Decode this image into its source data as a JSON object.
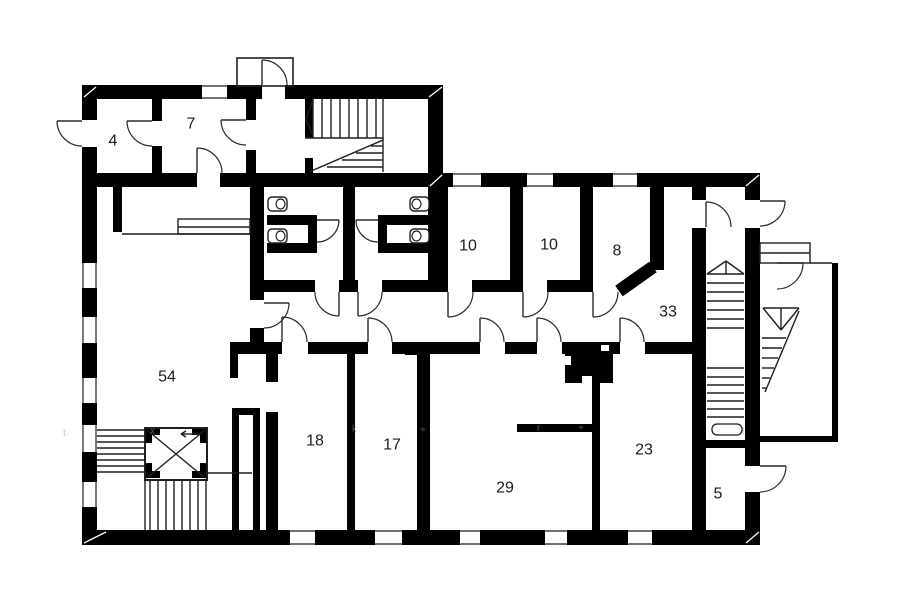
{
  "meta": {
    "title": "floor-plan",
    "bg": "#ffffff",
    "wall_color": "#000000",
    "line_color": "#1f1f1f",
    "door_color": "#2a2a2a",
    "label_color": "#1c1c1c",
    "watermark_color": "#9a9a9a",
    "label_font_size": 16
  },
  "labels": [
    {
      "t": "4",
      "x": 113,
      "y": 141
    },
    {
      "t": "7",
      "x": 191,
      "y": 124
    },
    {
      "t": "10",
      "x": 468,
      "y": 246
    },
    {
      "t": "10",
      "x": 549,
      "y": 245
    },
    {
      "t": "8",
      "x": 617,
      "y": 251
    },
    {
      "t": "33",
      "x": 668,
      "y": 312
    },
    {
      "t": "54",
      "x": 167,
      "y": 377
    },
    {
      "t": "18",
      "x": 315,
      "y": 441
    },
    {
      "t": "17",
      "x": 392,
      "y": 445
    },
    {
      "t": "29",
      "x": 505,
      "y": 488
    },
    {
      "t": "23",
      "x": 644,
      "y": 450
    },
    {
      "t": "5",
      "x": 718,
      "y": 494
    }
  ],
  "walls": [
    [
      82,
      85,
      15,
      35
    ],
    [
      82,
      147,
      15,
      398
    ],
    [
      82,
      85,
      180,
      14
    ],
    [
      285,
      85,
      158,
      14
    ],
    [
      428,
      85,
      15,
      102
    ],
    [
      443,
      173,
      317,
      14
    ],
    [
      82,
      173,
      115,
      14
    ],
    [
      220,
      173,
      223,
      14
    ],
    [
      745,
      173,
      15,
      27
    ],
    [
      745,
      228,
      15,
      238
    ],
    [
      745,
      492,
      15,
      53
    ],
    [
      82,
      530,
      678,
      15
    ],
    [
      152,
      97,
      10,
      24
    ],
    [
      152,
      146,
      10,
      27
    ],
    [
      246,
      97,
      10,
      23
    ],
    [
      246,
      150,
      10,
      23
    ],
    [
      305,
      98,
      8,
      40
    ],
    [
      305,
      158,
      8,
      29
    ],
    [
      250,
      186,
      14,
      114
    ],
    [
      250,
      328,
      14,
      14
    ],
    [
      343,
      186,
      12,
      94
    ],
    [
      428,
      186,
      20,
      94
    ],
    [
      510,
      186,
      13,
      94
    ],
    [
      580,
      186,
      13,
      94
    ],
    [
      650,
      186,
      14,
      84
    ],
    [
      692,
      187,
      14,
      13
    ],
    [
      692,
      228,
      14,
      302
    ],
    [
      255,
      280,
      60,
      12
    ],
    [
      339,
      280,
      19,
      12
    ],
    [
      382,
      280,
      66,
      12
    ],
    [
      472,
      280,
      51,
      12
    ],
    [
      547,
      280,
      46,
      12
    ],
    [
      230,
      342,
      52,
      12
    ],
    [
      308,
      342,
      60,
      12
    ],
    [
      392,
      342,
      88,
      12
    ],
    [
      505,
      342,
      32,
      12
    ],
    [
      562,
      342,
      58,
      12
    ],
    [
      645,
      342,
      61,
      12
    ],
    [
      347,
      354,
      8,
      176
    ],
    [
      417,
      343,
      13,
      189
    ],
    [
      405,
      343,
      12,
      12
    ],
    [
      266,
      354,
      12,
      28
    ],
    [
      266,
      412,
      12,
      118
    ],
    [
      592,
      382,
      8,
      148
    ],
    [
      517,
      424,
      80,
      8
    ],
    [
      692,
      440,
      68,
      8
    ],
    [
      565,
      345,
      48,
      38
    ],
    [
      267,
      215,
      50,
      10
    ],
    [
      267,
      243,
      50,
      10
    ],
    [
      308,
      225,
      9,
      18
    ],
    [
      378,
      215,
      50,
      10
    ],
    [
      378,
      243,
      50,
      10
    ],
    [
      378,
      225,
      9,
      18
    ],
    [
      232,
      408,
      28,
      7
    ],
    [
      232,
      415,
      7,
      117
    ],
    [
      253,
      415,
      7,
      117
    ],
    [
      230,
      354,
      8,
      24
    ],
    [
      832,
      263,
      6,
      179
    ],
    [
      760,
      436,
      78,
      6
    ],
    [
      113,
      186,
      9,
      46
    ],
    [
      145,
      428,
      15,
      7
    ],
    [
      145,
      428,
      7,
      15
    ],
    [
      192,
      428,
      15,
      7
    ],
    [
      200,
      428,
      7,
      15
    ],
    [
      145,
      471,
      15,
      7
    ],
    [
      145,
      463,
      7,
      15
    ],
    [
      192,
      471,
      15,
      7
    ],
    [
      200,
      463,
      7,
      15
    ]
  ],
  "chamfers": [
    {
      "x1": 619,
      "y1": 291,
      "x2": 653,
      "y2": 267,
      "w": 13
    }
  ],
  "white_notches": [
    [
      565,
      356,
      6,
      9
    ],
    [
      582,
      376,
      10,
      7
    ],
    [
      601,
      345,
      8,
      6
    ]
  ],
  "corner_ticks": [
    [
      84,
      97,
      96,
      87
    ],
    [
      429,
      97,
      442,
      87
    ],
    [
      430,
      186,
      442,
      175
    ],
    [
      746,
      186,
      759,
      175
    ],
    [
      84,
      543,
      106,
      532
    ],
    [
      746,
      543,
      759,
      532
    ]
  ],
  "windows": [
    [
      82,
      263,
      15,
      25
    ],
    [
      82,
      317,
      15,
      26
    ],
    [
      82,
      378,
      15,
      25
    ],
    [
      82,
      425,
      15,
      27
    ],
    [
      82,
      482,
      15,
      25
    ],
    [
      202,
      85,
      25,
      14
    ],
    [
      453,
      173,
      28,
      14
    ],
    [
      527,
      173,
      26,
      14
    ],
    [
      613,
      173,
      24,
      14
    ],
    [
      290,
      530,
      25,
      15
    ],
    [
      375,
      530,
      27,
      15
    ],
    [
      460,
      530,
      20,
      15
    ],
    [
      545,
      530,
      22,
      15
    ],
    [
      628,
      530,
      24,
      15
    ]
  ],
  "outline_rects": [
    {
      "x": 237,
      "y": 58,
      "w": 56,
      "h": 28,
      "sw": 1.6,
      "rx": 0,
      "name": "entrance-vestibule"
    },
    {
      "x": 760,
      "y": 243,
      "w": 50,
      "h": 20,
      "sw": 1.4,
      "rx": 0,
      "name": "exterior-landing"
    },
    {
      "x": 178,
      "y": 219,
      "w": 72,
      "h": 15,
      "sw": 1.4,
      "rx": 0,
      "name": "counter"
    },
    {
      "x": 145,
      "y": 428,
      "w": 62,
      "h": 52,
      "sw": 2,
      "rx": 0,
      "name": "elevator-shaft"
    },
    {
      "x": 712,
      "y": 424,
      "w": 30,
      "h": 11,
      "sw": 1.3,
      "rx": 5,
      "name": "stair-handrail-end"
    }
  ],
  "thin_lines": [
    [
      313,
      99,
      313,
      138
    ],
    [
      322,
      99,
      322,
      138
    ],
    [
      331,
      99,
      331,
      138
    ],
    [
      340,
      99,
      340,
      138
    ],
    [
      349,
      99,
      349,
      138
    ],
    [
      358,
      99,
      358,
      138
    ],
    [
      367,
      99,
      367,
      138
    ],
    [
      376,
      99,
      376,
      138
    ],
    [
      313,
      100,
      306,
      119
    ],
    [
      313,
      136,
      306,
      119
    ],
    [
      305,
      138,
      383,
      138
    ],
    [
      383,
      99,
      383,
      172
    ],
    [
      309,
      172,
      383,
      140
    ],
    [
      371,
      146,
      383,
      146
    ],
    [
      356,
      153,
      383,
      153
    ],
    [
      342,
      160,
      383,
      160
    ],
    [
      327,
      167,
      383,
      167
    ],
    [
      97,
      430,
      145,
      430
    ],
    [
      97,
      436,
      145,
      436
    ],
    [
      97,
      442,
      145,
      442
    ],
    [
      97,
      448,
      145,
      448
    ],
    [
      97,
      454,
      145,
      454
    ],
    [
      97,
      460,
      145,
      460
    ],
    [
      97,
      466,
      145,
      466
    ],
    [
      97,
      472,
      145,
      472
    ],
    [
      150,
      481,
      150,
      530
    ],
    [
      158,
      481,
      158,
      530
    ],
    [
      166,
      481,
      166,
      530
    ],
    [
      174,
      481,
      174,
      530
    ],
    [
      182,
      481,
      182,
      530
    ],
    [
      190,
      481,
      190,
      530
    ],
    [
      198,
      481,
      198,
      530
    ],
    [
      145,
      481,
      145,
      530
    ],
    [
      206,
      481,
      206,
      530
    ],
    [
      207,
      473,
      252,
      473
    ],
    [
      147,
      430,
      205,
      478
    ],
    [
      205,
      430,
      147,
      478
    ],
    [
      196,
      434,
      181,
      434
    ],
    [
      181,
      434,
      186,
      431
    ],
    [
      181,
      434,
      186,
      437
    ],
    [
      707,
      274,
      726,
      261
    ],
    [
      744,
      274,
      726,
      261
    ],
    [
      726,
      261,
      726,
      274
    ],
    [
      707,
      274,
      744,
      274
    ],
    [
      707,
      283,
      744,
      283
    ],
    [
      707,
      292,
      744,
      292
    ],
    [
      707,
      301,
      744,
      301
    ],
    [
      707,
      310,
      744,
      310
    ],
    [
      707,
      319,
      744,
      319
    ],
    [
      707,
      328,
      744,
      328
    ],
    [
      707,
      368,
      744,
      368
    ],
    [
      707,
      377,
      744,
      377
    ],
    [
      707,
      385,
      744,
      385
    ],
    [
      707,
      393,
      744,
      393
    ],
    [
      707,
      401,
      744,
      401
    ],
    [
      707,
      409,
      744,
      409
    ],
    [
      707,
      417,
      744,
      417
    ],
    [
      763,
      308,
      799,
      308
    ],
    [
      763,
      308,
      781,
      330
    ],
    [
      799,
      308,
      781,
      330
    ],
    [
      781,
      308,
      781,
      330
    ],
    [
      799,
      311,
      765,
      392
    ],
    [
      762,
      338,
      786,
      338
    ],
    [
      762,
      348,
      782,
      348
    ],
    [
      762,
      358,
      778,
      358
    ],
    [
      762,
      368,
      774,
      368
    ],
    [
      762,
      378,
      770,
      378
    ],
    [
      762,
      388,
      766,
      388
    ],
    [
      810,
      263,
      832,
      263
    ],
    [
      760,
      253,
      810,
      253
    ],
    [
      122,
      234,
      250,
      234
    ],
    [
      178,
      227,
      250,
      227
    ]
  ],
  "doors": [
    {
      "leaf": [
        82,
        121,
        57,
        121
      ],
      "end": [
        82,
        146
      ],
      "s": 0,
      "name": "door-room4-exterior"
    },
    {
      "leaf": [
        152,
        121,
        127,
        121
      ],
      "end": [
        152,
        146
      ],
      "s": 0,
      "name": "door-room4-room7"
    },
    {
      "leaf": [
        246,
        120,
        221,
        120
      ],
      "end": [
        246,
        145
      ],
      "s": 0,
      "name": "door-room7-corridor"
    },
    {
      "leaf": [
        197,
        173,
        197,
        148
      ],
      "end": [
        222,
        173
      ],
      "s": 1,
      "name": "door-room7-south"
    },
    {
      "leaf": [
        262,
        85,
        262,
        60
      ],
      "end": [
        287,
        85
      ],
      "s": 1,
      "name": "door-vestibule"
    },
    {
      "leaf": [
        264,
        303,
        289,
        303
      ],
      "end": [
        264,
        328
      ],
      "s": 1,
      "name": "door-room54-corridor"
    },
    {
      "leaf": [
        339,
        292,
        339,
        316
      ],
      "end": [
        315,
        292
      ],
      "s": 1,
      "name": "door-bath-left"
    },
    {
      "leaf": [
        358,
        292,
        358,
        316
      ],
      "end": [
        382,
        292
      ],
      "s": 0,
      "name": "door-bath-right"
    },
    {
      "leaf": [
        448,
        292,
        448,
        317
      ],
      "end": [
        473,
        292
      ],
      "s": 0,
      "name": "door-room10a"
    },
    {
      "leaf": [
        523,
        292,
        523,
        317
      ],
      "end": [
        548,
        292
      ],
      "s": 0,
      "name": "door-room10b"
    },
    {
      "leaf": [
        593,
        292,
        593,
        317
      ],
      "end": [
        618,
        292
      ],
      "s": 0,
      "name": "door-room8"
    },
    {
      "leaf": [
        282,
        342,
        282,
        317
      ],
      "end": [
        307,
        342
      ],
      "s": 1,
      "name": "door-room18"
    },
    {
      "leaf": [
        368,
        342,
        368,
        318
      ],
      "end": [
        392,
        342
      ],
      "s": 1,
      "name": "door-room17"
    },
    {
      "leaf": [
        480,
        342,
        480,
        318
      ],
      "end": [
        504,
        342
      ],
      "s": 1,
      "name": "door-room29-a"
    },
    {
      "leaf": [
        537,
        342,
        537,
        318
      ],
      "end": [
        561,
        342
      ],
      "s": 1,
      "name": "door-room29-b"
    },
    {
      "leaf": [
        620,
        342,
        620,
        318
      ],
      "end": [
        644,
        342
      ],
      "s": 1,
      "name": "door-room23"
    },
    {
      "leaf": [
        706,
        227,
        706,
        202
      ],
      "end": [
        731,
        227
      ],
      "s": 1,
      "name": "door-stairwell"
    },
    {
      "leaf": [
        760,
        201,
        785,
        201
      ],
      "end": [
        760,
        226
      ],
      "s": 1,
      "name": "door-exit-east"
    },
    {
      "leaf": [
        760,
        466,
        786,
        466
      ],
      "end": [
        760,
        492
      ],
      "s": 1,
      "name": "door-room5-exterior"
    },
    {
      "leaf": [
        777,
        263,
        803,
        263
      ],
      "end": [
        777,
        289
      ],
      "s": 1,
      "name": "door-exterior-landing"
    },
    {
      "leaf": [
        317,
        220,
        339,
        220
      ],
      "end": [
        317,
        242
      ],
      "s": 1,
      "name": "door-wc-stall-left"
    },
    {
      "leaf": [
        378,
        220,
        356,
        220
      ],
      "end": [
        378,
        242
      ],
      "s": 0,
      "name": "door-wc-stall-right"
    }
  ],
  "toilets": [
    {
      "x": 268,
      "y": 197,
      "flip": false
    },
    {
      "x": 268,
      "y": 229,
      "flip": false
    },
    {
      "x": 410,
      "y": 197,
      "flip": true
    },
    {
      "x": 410,
      "y": 229,
      "flip": true
    }
  ],
  "watermarks": [
    {
      "t": "t",
      "x": 63,
      "y": 436
    },
    {
      "t": "x",
      "x": 150,
      "y": 434
    },
    {
      "t": "k",
      "x": 352,
      "y": 432
    },
    {
      "t": "+",
      "x": 420,
      "y": 433
    },
    {
      "t": "r",
      "x": 537,
      "y": 431
    },
    {
      "t": "+",
      "x": 578,
      "y": 431
    },
    {
      "t": "t",
      "x": 742,
      "y": 434
    }
  ]
}
